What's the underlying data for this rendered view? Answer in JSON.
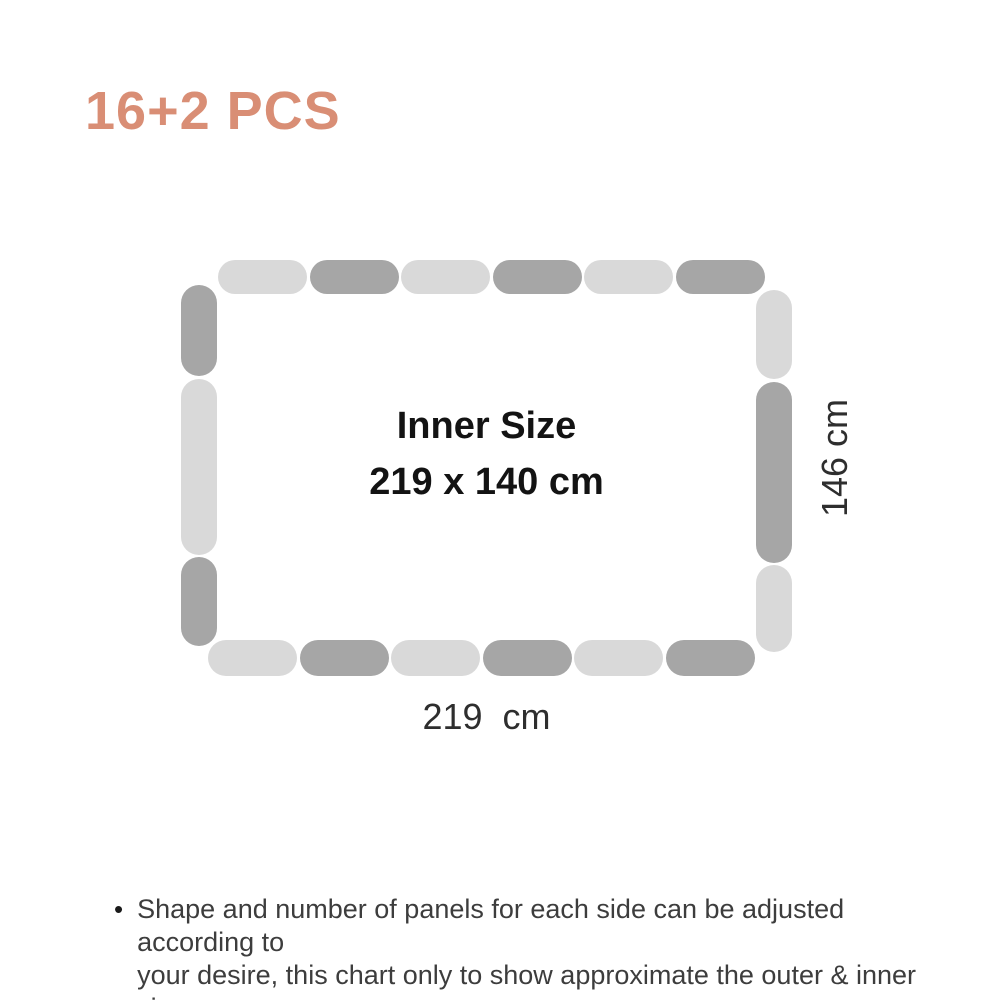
{
  "title": {
    "text": "16+2 PCS",
    "color": "#D98E75"
  },
  "diagram": {
    "palette": {
      "light": "#D9D9D9",
      "dark": "#A6A6A6"
    },
    "inner_label": {
      "line1": "Inner Size",
      "line2": "219 x 140 cm"
    },
    "outer_width_label": "219  cm",
    "outer_height_label": "146 cm",
    "sides": {
      "top": [
        {
          "tone": "light",
          "len": 89
        },
        {
          "tone": "dark",
          "len": 89
        },
        {
          "tone": "light",
          "len": 89
        },
        {
          "tone": "dark",
          "len": 89
        },
        {
          "tone": "light",
          "len": 89
        },
        {
          "tone": "dark",
          "len": 89
        }
      ],
      "right": [
        {
          "tone": "light",
          "len": 89
        },
        {
          "tone": "dark",
          "len": 181
        },
        {
          "tone": "light",
          "len": 87
        }
      ],
      "bottom": [
        {
          "tone": "light",
          "len": 89
        },
        {
          "tone": "dark",
          "len": 89
        },
        {
          "tone": "light",
          "len": 89
        },
        {
          "tone": "dark",
          "len": 89
        },
        {
          "tone": "light",
          "len": 89
        },
        {
          "tone": "dark",
          "len": 89
        }
      ],
      "left": [
        {
          "tone": "dark",
          "len": 91
        },
        {
          "tone": "light",
          "len": 176
        },
        {
          "tone": "dark",
          "len": 89
        }
      ]
    }
  },
  "footnote": {
    "bullet": "•",
    "lines": [
      "Shape and number of panels for each side can be adjusted according to",
      "your desire, this chart only to show approximate the outer & inner size."
    ]
  }
}
